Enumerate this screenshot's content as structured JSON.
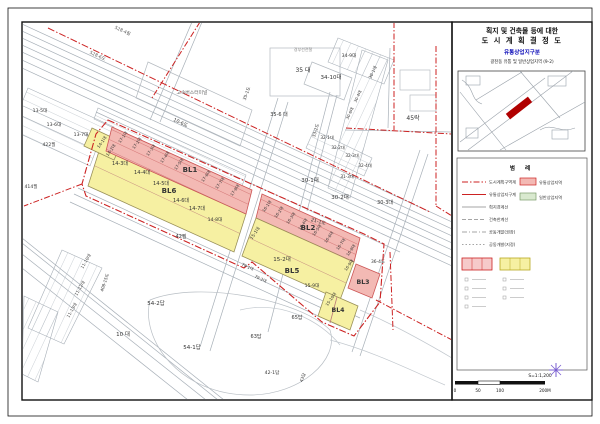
{
  "title_block": {
    "line1": "획지 및 건축물 등에 대한",
    "line2": "도 시 계 획 결 정 도",
    "line3": "유통상업지구분",
    "line3_color": "#1515bb",
    "line4": "광천동 유통 및 일반상업지역 (9-2)"
  },
  "key_map": {
    "highlight_color": "#b00000"
  },
  "legend": {
    "title": "범    례",
    "left_items": [
      {
        "label": "도시계획구역계",
        "color": "#cc2222",
        "dash": "6 2 1.5 2",
        "w": 1.1
      },
      {
        "label": "유통상업지구계",
        "color": "#cc2222",
        "dash": "",
        "w": 1
      },
      {
        "label": "획지경계선",
        "color": "#888888",
        "dash": "",
        "w": 0.8
      },
      {
        "label": "건축한계선",
        "color": "#888888",
        "dash": "4 2",
        "w": 0.8
      },
      {
        "label": "공동개발(권장)",
        "color": "#888888",
        "dash": "5 2 1 2",
        "w": 0.8
      },
      {
        "label": "공동개발(지정)",
        "color": "#888888",
        "dash": "1.5 2",
        "w": 0.8
      }
    ],
    "right_items": [
      {
        "label": "유통상업지역",
        "swatch": "pink"
      },
      {
        "label": "일반상업지역",
        "swatch": "green"
      }
    ]
  },
  "scale_bar": {
    "ratio_label": "S=1:1,200",
    "ticks": [
      {
        "label": "0",
        "x": 455
      },
      {
        "label": "50",
        "x": 478
      },
      {
        "label": "100",
        "x": 500
      },
      {
        "label": "200M",
        "x": 545
      }
    ]
  },
  "north_star_color": "#7a5fd0",
  "map": {
    "strip_colors": {
      "yellow": "#f6f0a2",
      "pink": "#f3b9b4",
      "red_line": "#cc2222"
    },
    "landmark": "고속버스터미널",
    "rail_label": "경부선전철",
    "labels": [
      {
        "t": "BL1",
        "x": 190,
        "y": 172,
        "s": 7,
        "b": 1
      },
      {
        "t": "BL2",
        "x": 308,
        "y": 230,
        "s": 7,
        "b": 1
      },
      {
        "t": "BL3",
        "x": 363,
        "y": 284,
        "s": 6.2,
        "b": 1
      },
      {
        "t": "BL4",
        "x": 338,
        "y": 312,
        "s": 6.2,
        "b": 1
      },
      {
        "t": "BL5",
        "x": 292,
        "y": 273,
        "s": 7,
        "b": 1
      },
      {
        "t": "BL6",
        "x": 169,
        "y": 193,
        "s": 7,
        "b": 1
      },
      {
        "t": "14-1대",
        "x": 103,
        "y": 143,
        "r": -55,
        "s": 4.2
      },
      {
        "t": "14-2대",
        "x": 112,
        "y": 151,
        "r": -55,
        "s": 4.2
      },
      {
        "t": "14-3대",
        "x": 120,
        "y": 165,
        "s": 5
      },
      {
        "t": "14-4대",
        "x": 142,
        "y": 174,
        "s": 5
      },
      {
        "t": "14-5대",
        "x": 161,
        "y": 185,
        "s": 5
      },
      {
        "t": "14-6대",
        "x": 181,
        "y": 202,
        "s": 5
      },
      {
        "t": "14-7대",
        "x": 197,
        "y": 210,
        "s": 5
      },
      {
        "t": "14-8대",
        "x": 215,
        "y": 221,
        "s": 4.6
      },
      {
        "t": "17-1대",
        "x": 124,
        "y": 138,
        "r": -55,
        "s": 4
      },
      {
        "t": "17-2대",
        "x": 138,
        "y": 144,
        "r": -55,
        "s": 4
      },
      {
        "t": "17-3대",
        "x": 152,
        "y": 151,
        "r": -55,
        "s": 4
      },
      {
        "t": "17-4대",
        "x": 166,
        "y": 158,
        "r": -55,
        "s": 4
      },
      {
        "t": "17-5대",
        "x": 180,
        "y": 165,
        "r": -55,
        "s": 4
      },
      {
        "t": "17-6대",
        "x": 207,
        "y": 177,
        "r": -55,
        "s": 4
      },
      {
        "t": "17-7대",
        "x": 221,
        "y": 184,
        "r": -55,
        "s": 4
      },
      {
        "t": "17-8대",
        "x": 236,
        "y": 191,
        "r": -55,
        "s": 4
      },
      {
        "t": "16-1대",
        "x": 268,
        "y": 207,
        "r": -55,
        "s": 4
      },
      {
        "t": "16-2대",
        "x": 280,
        "y": 213,
        "r": -55,
        "s": 4
      },
      {
        "t": "16-3대",
        "x": 292,
        "y": 219,
        "r": -55,
        "s": 4
      },
      {
        "t": "16-4대",
        "x": 304,
        "y": 225,
        "r": -55,
        "s": 4
      },
      {
        "t": "16-5대",
        "x": 318,
        "y": 231,
        "r": -55,
        "s": 4
      },
      {
        "t": "16-6대",
        "x": 330,
        "y": 238,
        "r": -55,
        "s": 4
      },
      {
        "t": "16-7대",
        "x": 342,
        "y": 245,
        "r": -55,
        "s": 4
      },
      {
        "t": "16-8대",
        "x": 352,
        "y": 251,
        "r": -55,
        "s": 4
      },
      {
        "t": "16-9대",
        "x": 350,
        "y": 266,
        "r": -55,
        "s": 4
      },
      {
        "t": "15-1대",
        "x": 256,
        "y": 234,
        "r": -55,
        "s": 4.4
      },
      {
        "t": "15-2대",
        "x": 282,
        "y": 261,
        "s": 5.5
      },
      {
        "t": "15-9대",
        "x": 312,
        "y": 287,
        "s": 4.6
      },
      {
        "t": "15-10대",
        "x": 332,
        "y": 300,
        "r": -55,
        "s": 4
      },
      {
        "t": "528-4필",
        "x": 122,
        "y": 32,
        "r": 25,
        "s": 4.4,
        "c": "#555555"
      },
      {
        "t": "528-6도",
        "x": 97,
        "y": 57,
        "r": 25,
        "s": 4.4,
        "c": "#555555"
      },
      {
        "t": "13-5대",
        "x": 40,
        "y": 112,
        "s": 4.6
      },
      {
        "t": "13-6대",
        "x": 54,
        "y": 126,
        "s": 4.6
      },
      {
        "t": "13-7대",
        "x": 81,
        "y": 136,
        "s": 4.6
      },
      {
        "t": "422필",
        "x": 49,
        "y": 146,
        "s": 4.6
      },
      {
        "t": "414필",
        "x": 31,
        "y": 188,
        "s": 4.6
      },
      {
        "t": "10-6도",
        "x": 180,
        "y": 124,
        "r": 25,
        "s": 4.8
      },
      {
        "t": "고속버스터미널",
        "x": 192,
        "y": 94,
        "s": 4.8,
        "c": "#666666"
      },
      {
        "t": "35 대",
        "x": 303,
        "y": 72,
        "s": 6
      },
      {
        "t": "35-6 대",
        "x": 279,
        "y": 116,
        "s": 5
      },
      {
        "t": "35-1도",
        "x": 248,
        "y": 94,
        "r": -70,
        "s": 4.4
      },
      {
        "t": "경부선전철",
        "x": 303,
        "y": 51,
        "s": 4,
        "c": "#888888"
      },
      {
        "t": "34-9대",
        "x": 349,
        "y": 57,
        "s": 4.6
      },
      {
        "t": "34-10대",
        "x": 331,
        "y": 79,
        "s": 5.5
      },
      {
        "t": "30-1대",
        "x": 374,
        "y": 73,
        "r": -65,
        "s": 4.2
      },
      {
        "t": "30-4대",
        "x": 359,
        "y": 97,
        "r": -65,
        "s": 4
      },
      {
        "t": "30-6대",
        "x": 351,
        "y": 114,
        "r": -65,
        "s": 4
      },
      {
        "t": "45락",
        "x": 413,
        "y": 120,
        "s": 6
      },
      {
        "t": "33-2도",
        "x": 317,
        "y": 131,
        "r": -72,
        "s": 4.4
      },
      {
        "t": "32-1대",
        "x": 327,
        "y": 139,
        "s": 4.2
      },
      {
        "t": "32-2대",
        "x": 338,
        "y": 149,
        "s": 4.2
      },
      {
        "t": "32-3대",
        "x": 352,
        "y": 157,
        "s": 4.2
      },
      {
        "t": "32-4대",
        "x": 365,
        "y": 167,
        "s": 4.2
      },
      {
        "t": "31-3대",
        "x": 347,
        "y": 178,
        "s": 4.2
      },
      {
        "t": "30-1대",
        "x": 310,
        "y": 182,
        "s": 5.5
      },
      {
        "t": "30-2대",
        "x": 340,
        "y": 199,
        "s": 5.5
      },
      {
        "t": "30-3대",
        "x": 385,
        "y": 204,
        "s": 5
      },
      {
        "t": "21-1도",
        "x": 318,
        "y": 223,
        "r": 15,
        "s": 4.8
      },
      {
        "t": "36-4도",
        "x": 378,
        "y": 263,
        "s": 4.4
      },
      {
        "t": "42필",
        "x": 181,
        "y": 238,
        "s": 5
      },
      {
        "t": "79-1대",
        "x": 247,
        "y": 268,
        "r": 25,
        "s": 4
      },
      {
        "t": "79-2대",
        "x": 260,
        "y": 280,
        "r": 25,
        "s": 4
      },
      {
        "t": "11-10대",
        "x": 87,
        "y": 262,
        "r": -60,
        "s": 4.2
      },
      {
        "t": "11-12대",
        "x": 81,
        "y": 289,
        "r": -60,
        "s": 4.2
      },
      {
        "t": "11-13대",
        "x": 73,
        "y": 311,
        "r": -60,
        "s": 4.2
      },
      {
        "t": "408-15도",
        "x": 106,
        "y": 283,
        "r": -72,
        "s": 4.2
      },
      {
        "t": "10 대",
        "x": 123,
        "y": 336,
        "s": 5.5
      },
      {
        "t": "54-2답",
        "x": 156,
        "y": 305,
        "s": 5.5
      },
      {
        "t": "54-1답",
        "x": 192,
        "y": 349,
        "s": 5.5
      },
      {
        "t": "63답",
        "x": 256,
        "y": 338,
        "s": 5
      },
      {
        "t": "65답",
        "x": 297,
        "y": 319,
        "s": 5
      },
      {
        "t": "42-1답",
        "x": 272,
        "y": 374,
        "s": 4.6
      },
      {
        "t": "43답",
        "x": 304,
        "y": 378,
        "r": -70,
        "s": 4.2
      }
    ]
  }
}
